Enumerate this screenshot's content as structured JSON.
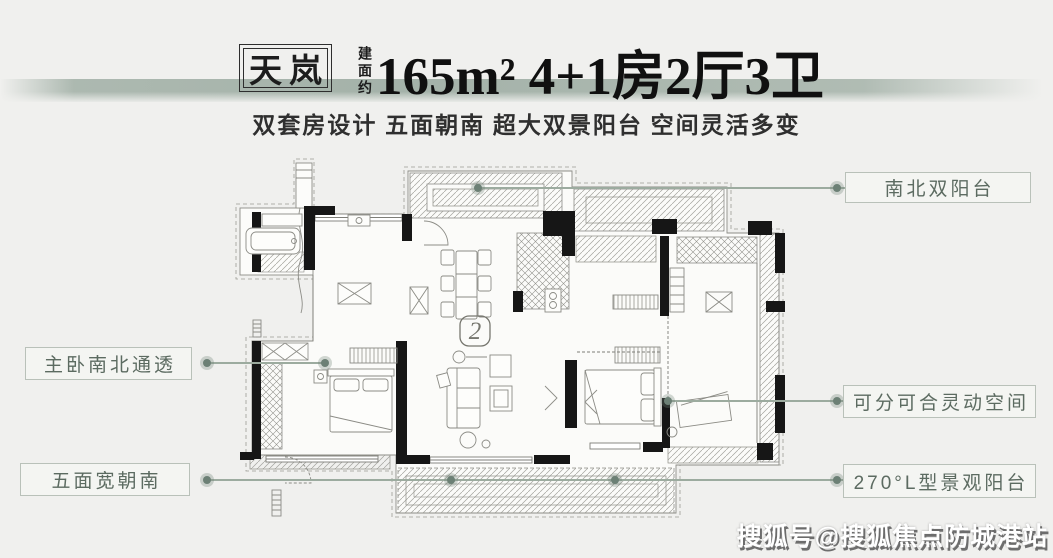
{
  "page": {
    "background": "#f0f0ee",
    "accent_band": "#a4b2a9"
  },
  "header": {
    "badge": "天岚",
    "area_label": "建面约",
    "headline": "165m² 4+1房2厅3卫",
    "subtitle": "双套房设计 五面朝南 超大双景阳台 空间灵活多变"
  },
  "callouts": {
    "north_balcony": {
      "label": "南北双阳台"
    },
    "master": {
      "label": "主卧南北通透"
    },
    "flex": {
      "label": "可分可合灵动空间"
    },
    "south_bays": {
      "label": "五面宽朝南"
    },
    "l_balcony": {
      "label": "270°L型景观阳台"
    }
  },
  "floor_plan": {
    "badge_numeral": "2"
  },
  "watermark": {
    "text": "搜狐号@搜狐焦点防城港站"
  },
  "colors": {
    "callout_text": "#5c6b61",
    "callout_border": "#b9c1b9",
    "leader_line": "#9cab9f",
    "wall": "#161616"
  }
}
